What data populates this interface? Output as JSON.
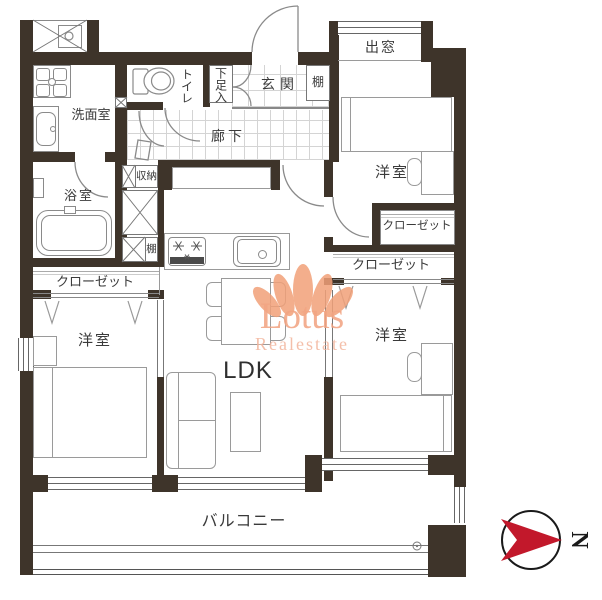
{
  "labels": {
    "entrance": "玄関",
    "corridor": "廊下",
    "toilet": "トイレ",
    "shoe_cabinet": "下足入",
    "washroom": "洗面室",
    "bathroom": "浴室",
    "storage": "収納",
    "shelf_entrance": "棚",
    "shelf_column": "棚",
    "bay_window": "出窓",
    "closet_west": "クローゼット",
    "closet_northeast": "クローゼット",
    "closet_east": "クローゼット",
    "room_northeast": "洋室",
    "room_southwest": "洋室",
    "room_southeast": "洋室",
    "ldk": "LDK",
    "balcony": "バルコニー"
  },
  "compass": {
    "label": "N",
    "arrow_color": "#c2182b"
  },
  "watermark": {
    "line1": "Lotus",
    "line2": "Realestate",
    "color": "#f2a17c"
  },
  "colors": {
    "wall": "#3e342a",
    "fixture_line": "#8a8a8a",
    "tile_line": "#d4d4d4",
    "text": "#3a3a3a"
  }
}
